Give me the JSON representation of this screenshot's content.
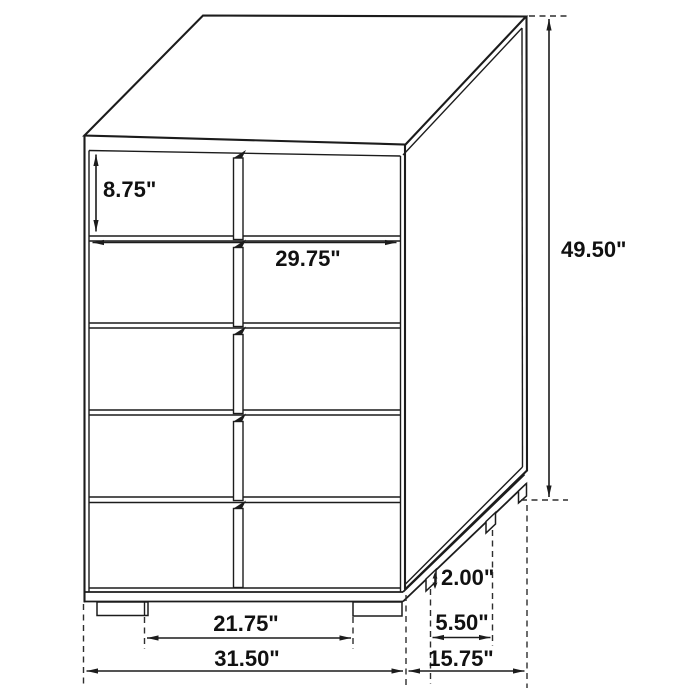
{
  "figure": {
    "type": "furniture-dimension-diagram",
    "subject": "five-drawer chest, three-quarter view line drawing",
    "unit": "inches"
  },
  "dimensions": {
    "drawer_height": "8.75\"",
    "drawer_width": "29.75\"",
    "overall_height": "49.50\"",
    "leg_height": "2.00\"",
    "leg_side_spacing": "5.50\"",
    "depth": "15.75\"",
    "front_leg_spacing": "21.75\"",
    "overall_width": "31.50\""
  },
  "colors": {
    "line": "#1c1c1c",
    "background": "#ffffff",
    "text": "#111111"
  }
}
